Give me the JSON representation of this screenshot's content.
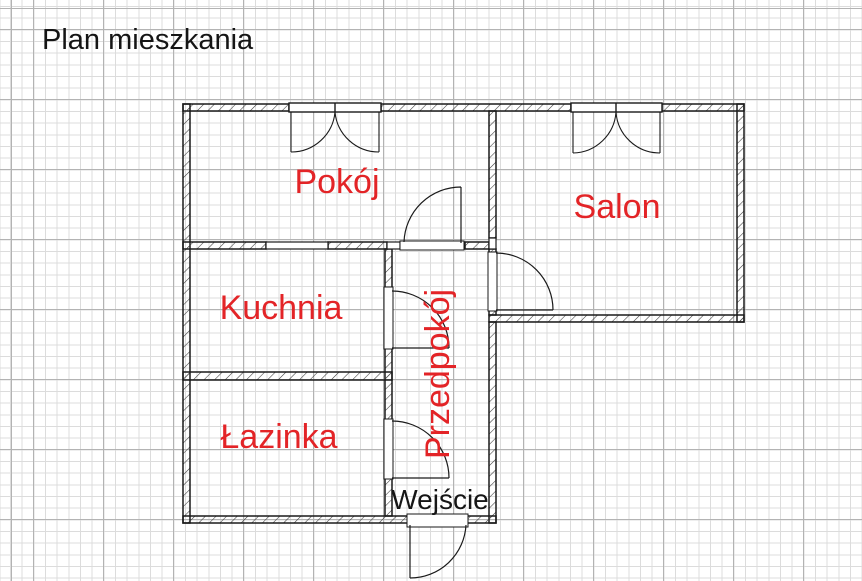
{
  "title": "Plan mieszkania",
  "rooms": [
    {
      "id": "pokoj",
      "label": "Pokój"
    },
    {
      "id": "salon",
      "label": "Salon"
    },
    {
      "id": "kuchnia",
      "label": "Kuchnia"
    },
    {
      "id": "lazinka",
      "label": "Łazinka"
    },
    {
      "id": "przedpokoj",
      "label": "Przedpokój"
    }
  ],
  "entrance": {
    "label": "Wejście"
  },
  "symbols": {
    "windows": [
      "pokoj-window",
      "salon-window"
    ],
    "doors": [
      "pokoj-door",
      "salon-door",
      "kuchnia-door",
      "lazinka-door",
      "entry-door"
    ]
  },
  "colors": {
    "room_label": "#e32427",
    "text": "#151515",
    "wall_line": "#1a1a1a",
    "hatch_line": "#3a3a3a",
    "grid_minor": "#dcdcdc",
    "grid_major": "#b3b3b3",
    "background": "#ffffff"
  }
}
